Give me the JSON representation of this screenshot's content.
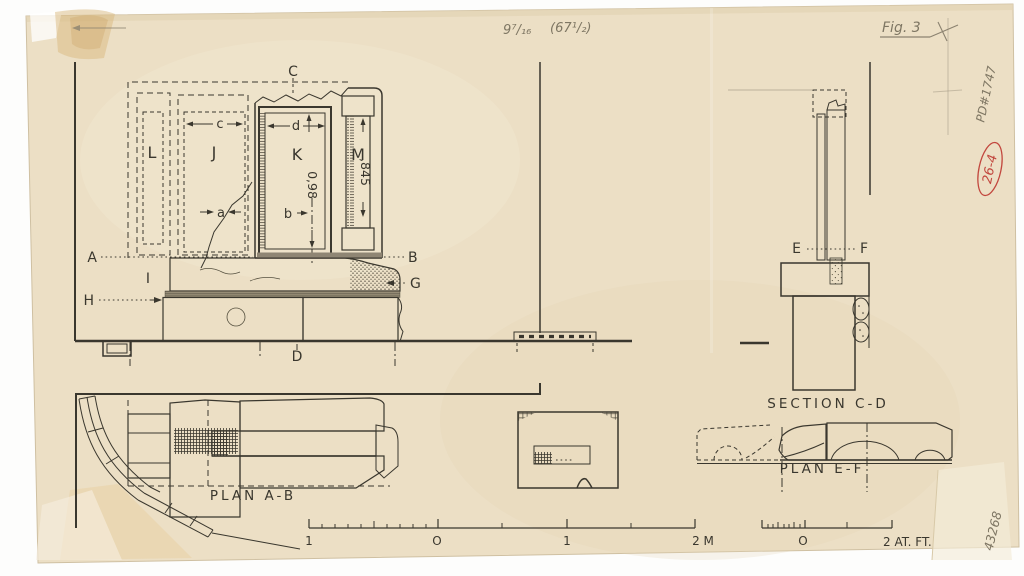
{
  "colors": {
    "paper": "#ecdfc5",
    "ink": "#3a372e",
    "pencil": "#857c69",
    "red_stamp": "#c2473e"
  },
  "annotations": {
    "size_note": "9⁷/₁₆",
    "size_note_paren": "(67¹/₂)",
    "figure_label": "Fig. 3",
    "inventory_number": "PD#1747",
    "red_stamp": "26-4",
    "corner_number": "43268"
  },
  "elevation": {
    "label_a": "A",
    "label_b": "B",
    "label_c": "C",
    "label_d": "D",
    "label_g": "G",
    "label_h": "H",
    "label_i": "I",
    "part_l": "L",
    "part_j": "J",
    "part_k": "K",
    "part_m": "M",
    "dim_c": "c",
    "dim_d": "d",
    "dim_a": "a",
    "dim_b": "b",
    "height_k": "0,98",
    "height_m": ",845"
  },
  "section_cd": {
    "title": "SECTION C-D",
    "label_e": "E",
    "label_f": "F"
  },
  "plan_ab": {
    "title": "PLAN A-B"
  },
  "plan_ef": {
    "title": "PLAN E-F"
  },
  "scale_metric": {
    "tick_1_left": "1",
    "tick_0": "O",
    "tick_1_right": "1",
    "tick_2": "2 M"
  },
  "scale_feet": {
    "tick_0": "O",
    "tick_2": "2 AT. FT."
  }
}
